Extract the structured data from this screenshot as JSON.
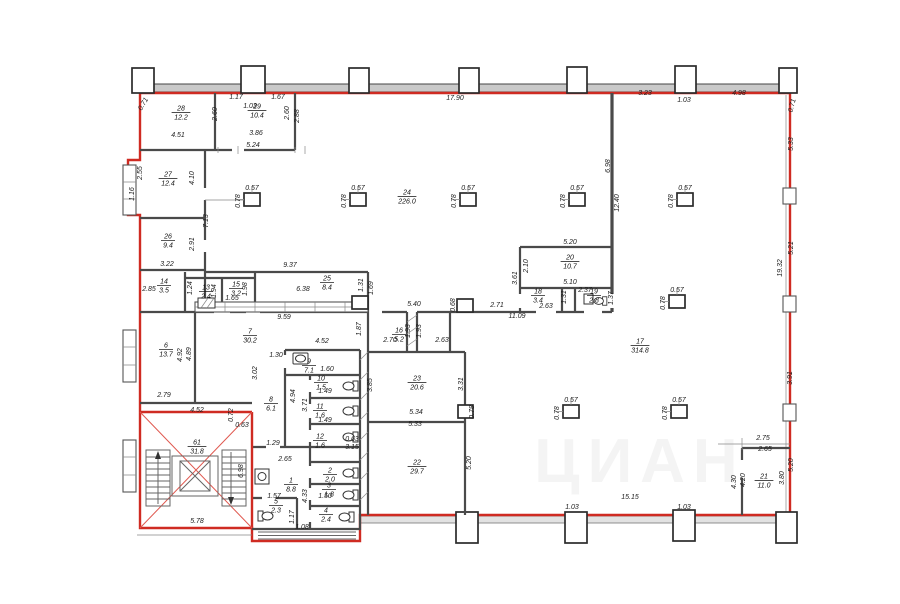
{
  "plan": {
    "watermark": "ЦИАН",
    "rooms": [
      {
        "n": "28",
        "a": "12.2",
        "x": 181,
        "y": 112
      },
      {
        "n": "29",
        "a": "10.4",
        "x": 257,
        "y": 110
      },
      {
        "n": "27",
        "a": "12.4",
        "x": 168,
        "y": 178
      },
      {
        "n": "26",
        "a": "9.4",
        "x": 168,
        "y": 240
      },
      {
        "n": "24",
        "a": "226.0",
        "x": 407,
        "y": 196
      },
      {
        "n": "14",
        "a": "3.5",
        "x": 164,
        "y": 285
      },
      {
        "n": "13",
        "a": "2.4",
        "x": 206,
        "y": 291
      },
      {
        "n": "15",
        "a": "3.2",
        "x": 236,
        "y": 288
      },
      {
        "n": "25",
        "a": "8.4",
        "x": 327,
        "y": 282
      },
      {
        "n": "20",
        "a": "10.7",
        "x": 570,
        "y": 261
      },
      {
        "n": "18",
        "a": "3.4",
        "x": 538,
        "y": 295
      },
      {
        "n": "19",
        "a": "2.8",
        "x": 594,
        "y": 295
      },
      {
        "n": "17",
        "a": "314.8",
        "x": 640,
        "y": 345
      },
      {
        "n": "6",
        "a": "13.7",
        "x": 166,
        "y": 349
      },
      {
        "n": "7",
        "a": "30.2",
        "x": 250,
        "y": 335
      },
      {
        "n": "9",
        "a": "7.1",
        "x": 309,
        "y": 365
      },
      {
        "n": "10",
        "a": "1.5",
        "x": 321,
        "y": 382
      },
      {
        "n": "11",
        "a": "1.6",
        "x": 320,
        "y": 410
      },
      {
        "n": "12",
        "a": "1.6",
        "x": 320,
        "y": 440
      },
      {
        "n": "8",
        "a": "6.1",
        "x": 271,
        "y": 403
      },
      {
        "n": "61",
        "a": "31.8",
        "x": 197,
        "y": 446
      },
      {
        "n": "1",
        "a": "8.8",
        "x": 291,
        "y": 484
      },
      {
        "n": "2",
        "a": "2.0",
        "x": 330,
        "y": 474
      },
      {
        "n": "3",
        "a": "1.8",
        "x": 329,
        "y": 489
      },
      {
        "n": "4",
        "a": "2.4",
        "x": 326,
        "y": 514
      },
      {
        "n": "5",
        "a": "2.3",
        "x": 276,
        "y": 505
      },
      {
        "n": "22",
        "a": "29.7",
        "x": 417,
        "y": 466
      },
      {
        "n": "23",
        "a": "20.6",
        "x": 417,
        "y": 382
      },
      {
        "n": "16",
        "a": "5.2",
        "x": 399,
        "y": 334
      },
      {
        "n": "21",
        "a": "11.0",
        "x": 764,
        "y": 480
      }
    ],
    "dims": [
      {
        "t": "0.71",
        "x": 145,
        "y": 105,
        "r": -60
      },
      {
        "t": "4.51",
        "x": 178,
        "y": 137
      },
      {
        "t": "2.60",
        "x": 217,
        "y": 114,
        "r": -90
      },
      {
        "t": "1.17",
        "x": 236,
        "y": 99
      },
      {
        "t": "1.03",
        "x": 250,
        "y": 108
      },
      {
        "t": "1.67",
        "x": 278,
        "y": 99
      },
      {
        "t": "3.86",
        "x": 256,
        "y": 135
      },
      {
        "t": "5.24",
        "x": 253,
        "y": 147
      },
      {
        "t": "2.60",
        "x": 289,
        "y": 113,
        "r": -90
      },
      {
        "t": "2.88",
        "x": 299,
        "y": 116,
        "r": -90
      },
      {
        "t": "17.90",
        "x": 455,
        "y": 100
      },
      {
        "t": "3.23",
        "x": 645,
        "y": 95
      },
      {
        "t": "1.03",
        "x": 684,
        "y": 102
      },
      {
        "t": "4.98",
        "x": 739,
        "y": 95
      },
      {
        "t": "0.71",
        "x": 794,
        "y": 106,
        "r": -75
      },
      {
        "t": "2.55",
        "x": 142,
        "y": 173,
        "r": -90
      },
      {
        "t": "4.10",
        "x": 194,
        "y": 178,
        "r": -90
      },
      {
        "t": "1.16",
        "x": 134,
        "y": 194,
        "r": -90
      },
      {
        "t": "7.13",
        "x": 208,
        "y": 221,
        "r": -90
      },
      {
        "t": "2.91",
        "x": 194,
        "y": 244,
        "r": -90
      },
      {
        "t": "3.22",
        "x": 167,
        "y": 266
      },
      {
        "t": "2.85",
        "x": 149,
        "y": 291
      },
      {
        "t": "1.24",
        "x": 192,
        "y": 288,
        "r": -90
      },
      {
        "t": "1.94",
        "x": 216,
        "y": 291,
        "r": -90
      },
      {
        "t": "1.98",
        "x": 247,
        "y": 289,
        "r": -90
      },
      {
        "t": "1.65",
        "x": 232,
        "y": 300
      },
      {
        "t": "9.37",
        "x": 290,
        "y": 267
      },
      {
        "t": "6.38",
        "x": 303,
        "y": 291
      },
      {
        "t": "1.31",
        "x": 363,
        "y": 285,
        "r": -90
      },
      {
        "t": "1.69",
        "x": 373,
        "y": 288,
        "r": -90
      },
      {
        "t": "9.59",
        "x": 284,
        "y": 319
      },
      {
        "t": "5.40",
        "x": 414,
        "y": 306
      },
      {
        "t": "0.68",
        "x": 455,
        "y": 305,
        "r": -90
      },
      {
        "t": "2.71",
        "x": 497,
        "y": 307
      },
      {
        "t": "11.09",
        "x": 517,
        "y": 318
      },
      {
        "t": "2.63",
        "x": 546,
        "y": 308
      },
      {
        "t": "5.20",
        "x": 570,
        "y": 244
      },
      {
        "t": "2.10",
        "x": 528,
        "y": 266,
        "r": -90
      },
      {
        "t": "3.61",
        "x": 517,
        "y": 278,
        "r": -90
      },
      {
        "t": "5.10",
        "x": 570,
        "y": 284
      },
      {
        "t": "2.37",
        "x": 585,
        "y": 292
      },
      {
        "t": "1.31",
        "x": 566,
        "y": 297,
        "r": -90
      },
      {
        "t": "1.37",
        "x": 613,
        "y": 298,
        "r": -90
      },
      {
        "t": "6.98",
        "x": 610,
        "y": 166,
        "r": -90
      },
      {
        "t": "12.40",
        "x": 619,
        "y": 203,
        "r": -90
      },
      {
        "t": "5.33",
        "x": 793,
        "y": 144,
        "r": -90
      },
      {
        "t": "5.21",
        "x": 793,
        "y": 248,
        "r": -90
      },
      {
        "t": "19.32",
        "x": 782,
        "y": 268,
        "r": -90
      },
      {
        "t": "3.91",
        "x": 792,
        "y": 378,
        "r": -90
      },
      {
        "t": "2.75",
        "x": 763,
        "y": 440
      },
      {
        "t": "2.65",
        "x": 765,
        "y": 451
      },
      {
        "t": "5.20",
        "x": 793,
        "y": 465,
        "r": -90
      },
      {
        "t": "3.80",
        "x": 784,
        "y": 478,
        "r": -90
      },
      {
        "t": "4.20",
        "x": 745,
        "y": 480,
        "r": -90
      },
      {
        "t": "4.30",
        "x": 736,
        "y": 482,
        "r": -90
      },
      {
        "t": "15.15",
        "x": 630,
        "y": 499
      },
      {
        "t": "1.03",
        "x": 572,
        "y": 509
      },
      {
        "t": "1.03",
        "x": 684,
        "y": 509
      },
      {
        "t": "1.87",
        "x": 361,
        "y": 329,
        "r": -90
      },
      {
        "t": "2.70",
        "x": 390,
        "y": 342
      },
      {
        "t": "1.93",
        "x": 410,
        "y": 331,
        "r": -90
      },
      {
        "t": "1.93",
        "x": 421,
        "y": 331,
        "r": -90
      },
      {
        "t": "2.63",
        "x": 442,
        "y": 342
      },
      {
        "t": "3.85",
        "x": 372,
        "y": 385,
        "r": -90
      },
      {
        "t": "3.31",
        "x": 463,
        "y": 384,
        "r": -90
      },
      {
        "t": "5.34",
        "x": 416,
        "y": 414
      },
      {
        "t": "5.33",
        "x": 415,
        "y": 426
      },
      {
        "t": "0.78",
        "x": 474,
        "y": 412,
        "r": -90
      },
      {
        "t": "5.20",
        "x": 471,
        "y": 463,
        "r": -90
      },
      {
        "t": "4.52",
        "x": 322,
        "y": 343
      },
      {
        "t": "1.30",
        "x": 276,
        "y": 357
      },
      {
        "t": "3.02",
        "x": 257,
        "y": 373,
        "r": -90
      },
      {
        "t": "1.60",
        "x": 327,
        "y": 371
      },
      {
        "t": "4.94",
        "x": 295,
        "y": 396,
        "r": -90
      },
      {
        "t": "3.71",
        "x": 307,
        "y": 405,
        "r": -90
      },
      {
        "t": "1.49",
        "x": 325,
        "y": 393
      },
      {
        "t": "1.49",
        "x": 325,
        "y": 422
      },
      {
        "t": "4.92",
        "x": 182,
        "y": 355,
        "r": -90
      },
      {
        "t": "4.89",
        "x": 191,
        "y": 354,
        "r": -90
      },
      {
        "t": "2.79",
        "x": 164,
        "y": 397
      },
      {
        "t": "4.52",
        "x": 197,
        "y": 412
      },
      {
        "t": "0.72",
        "x": 233,
        "y": 415,
        "r": -90
      },
      {
        "t": "0.63",
        "x": 242,
        "y": 427
      },
      {
        "t": "0.63",
        "x": 352,
        "y": 441
      },
      {
        "t": "3.15",
        "x": 352,
        "y": 449
      },
      {
        "t": "1.29",
        "x": 273,
        "y": 445
      },
      {
        "t": "2.65",
        "x": 285,
        "y": 461
      },
      {
        "t": "1.57",
        "x": 274,
        "y": 498
      },
      {
        "t": "1.50",
        "x": 325,
        "y": 498
      },
      {
        "t": "1.08",
        "x": 302,
        "y": 529
      },
      {
        "t": "1.17",
        "x": 294,
        "y": 517,
        "r": -90
      },
      {
        "t": "4.33",
        "x": 307,
        "y": 496,
        "r": -90
      },
      {
        "t": "5.78",
        "x": 197,
        "y": 523
      },
      {
        "t": "6.98",
        "x": 243,
        "y": 471,
        "r": -90
      },
      {
        "t": "0.57",
        "x": 252,
        "y": 190
      },
      {
        "t": "0.78",
        "x": 240,
        "y": 201,
        "r": -90
      },
      {
        "t": "0.57",
        "x": 358,
        "y": 190
      },
      {
        "t": "0.78",
        "x": 346,
        "y": 201,
        "r": -90
      },
      {
        "t": "0.57",
        "x": 468,
        "y": 190
      },
      {
        "t": "0.78",
        "x": 456,
        "y": 201,
        "r": -90
      },
      {
        "t": "0.57",
        "x": 577,
        "y": 190
      },
      {
        "t": "0.78",
        "x": 565,
        "y": 201,
        "r": -90
      },
      {
        "t": "0.57",
        "x": 685,
        "y": 190
      },
      {
        "t": "0.78",
        "x": 673,
        "y": 201,
        "r": -90
      },
      {
        "t": "0.57",
        "x": 677,
        "y": 292
      },
      {
        "t": "0.78",
        "x": 665,
        "y": 303,
        "r": -90
      },
      {
        "t": "0.57",
        "x": 571,
        "y": 402
      },
      {
        "t": "0.78",
        "x": 559,
        "y": 413,
        "r": -90
      },
      {
        "t": "0.57",
        "x": 679,
        "y": 402
      },
      {
        "t": "0.78",
        "x": 667,
        "y": 413,
        "r": -90
      }
    ]
  }
}
